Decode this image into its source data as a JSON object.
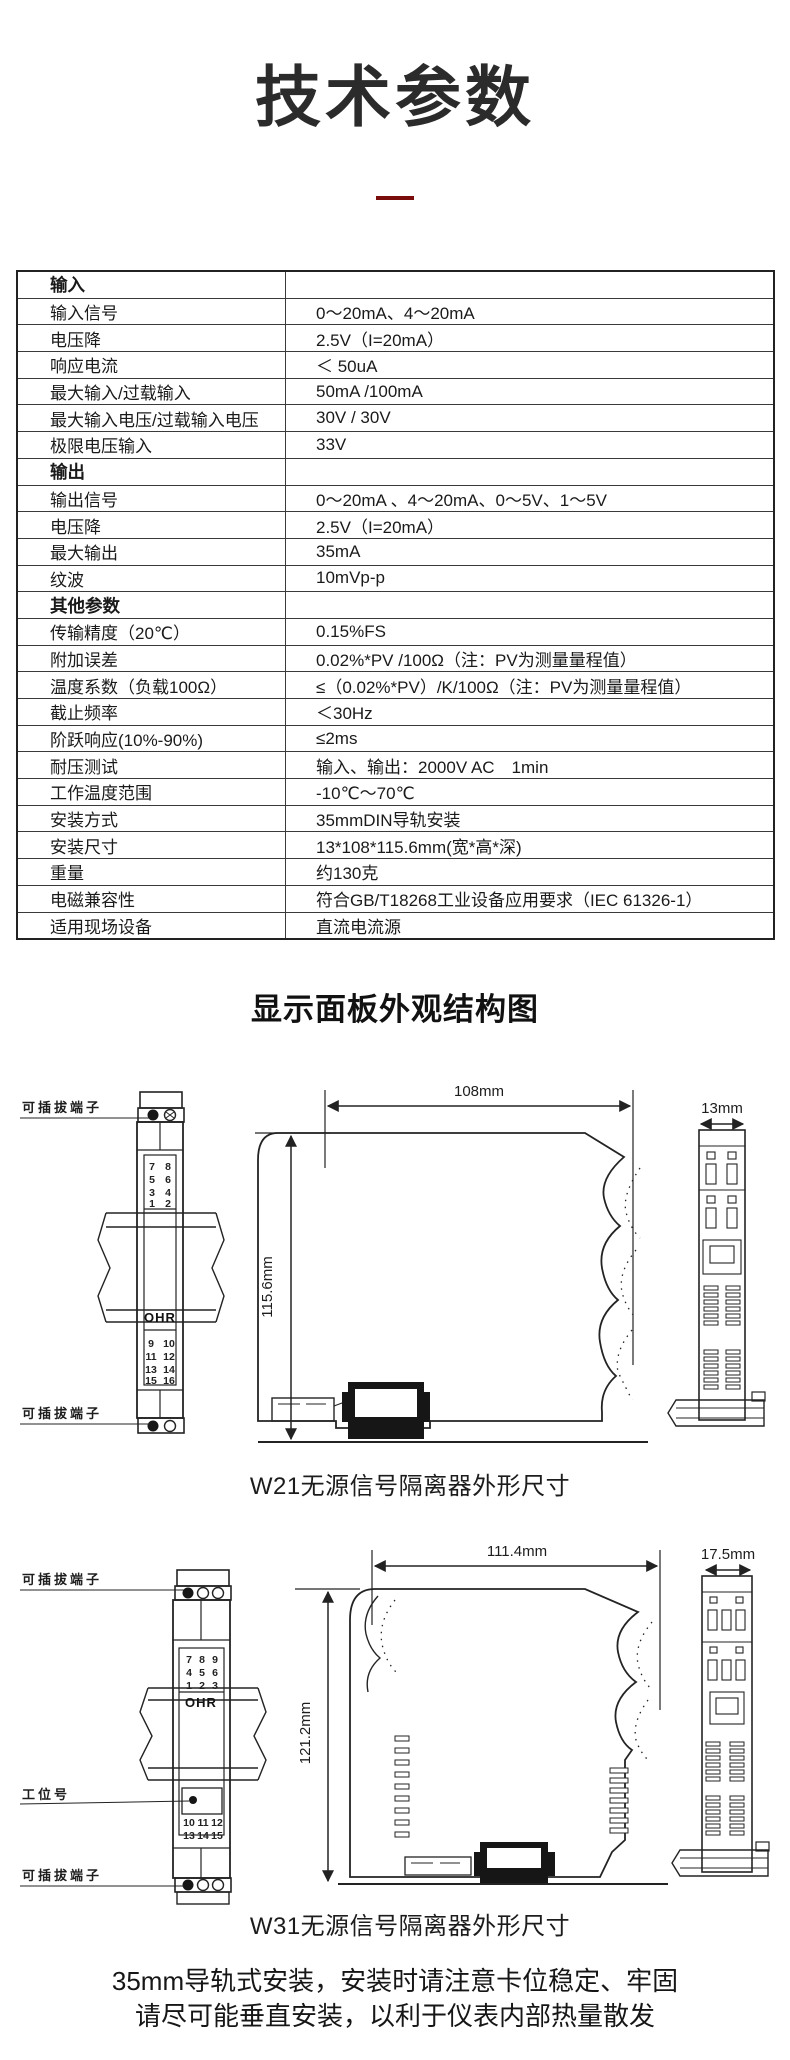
{
  "page": {
    "title": "技术参数",
    "accent_color": "#7a0c0c",
    "section_heading": "显示面板外观结构图",
    "footer_lines": [
      "35mm导轨式安装，安装时请注意卡位稳定、牢固",
      "请尽可能垂直安装，以利于仪表内部热量散发"
    ]
  },
  "spec_table": {
    "rows": [
      {
        "label": "输入",
        "value": "",
        "header": true
      },
      {
        "label": "输入信号",
        "value": "0～20mA、4～20mA",
        "header": false
      },
      {
        "label": "电压降",
        "value": "2.5V（I=20mA）",
        "header": false
      },
      {
        "label": "响应电流",
        "value": "＜ 50uA",
        "header": false
      },
      {
        "label": "最大输入/过载输入",
        "value": "50mA /100mA",
        "header": false
      },
      {
        "label": "最大输入电压/过载输入电压",
        "value": "30V / 30V",
        "header": false
      },
      {
        "label": "极限电压输入",
        "value": "33V",
        "header": false
      },
      {
        "label": "输出",
        "value": "",
        "header": true
      },
      {
        "label": "输出信号",
        "value": "0～20mA 、4～20mA、0～5V、1～5V",
        "header": false
      },
      {
        "label": "电压降",
        "value": "2.5V（I=20mA）",
        "header": false
      },
      {
        "label": "最大输出",
        "value": "35mA",
        "header": false
      },
      {
        "label": "纹波",
        "value": "10mVp-p",
        "header": false
      },
      {
        "label": "其他参数",
        "value": "",
        "header": true
      },
      {
        "label": "传输精度（20℃）",
        "value": "0.15%FS",
        "header": false
      },
      {
        "label": "附加误差",
        "value": "0.02%*PV /100Ω（注：PV为测量量程值）",
        "header": false
      },
      {
        "label": "温度系数（负载100Ω）",
        "value": "≤（0.02%*PV）/K/100Ω（注：PV为测量量程值）",
        "header": false
      },
      {
        "label": "截止频率",
        "value": "＜30Hz",
        "header": false
      },
      {
        "label": "阶跃响应(10%-90%)",
        "value": "≤2ms",
        "header": false
      },
      {
        "label": "耐压测试",
        "value": "输入、输出：2000V AC　1min",
        "header": false
      },
      {
        "label": "工作温度范围",
        "value": "-10℃～70℃",
        "header": false
      },
      {
        "label": "安装方式",
        "value": "35mmDIN导轨安装",
        "header": false
      },
      {
        "label": "安装尺寸",
        "value": "13*108*115.6mm(宽*高*深)",
        "header": false
      },
      {
        "label": "重量",
        "value": "约130克",
        "header": false
      },
      {
        "label": "电磁兼容性",
        "value": "符合GB/T18268工业设备应用要求（IEC 61326-1）",
        "header": false
      },
      {
        "label": "适用现场设备",
        "value": "直流电流源",
        "header": false
      }
    ]
  },
  "diagrams": {
    "w21": {
      "caption": "W21无源信号隔离器外形尺寸",
      "label_terminal_top": "可插拔端子",
      "label_terminal_bottom": "可插拔端子",
      "brand": "OHR",
      "terminals_top": [
        [
          "7",
          "8"
        ],
        [
          "5",
          "6"
        ],
        [
          "3",
          "4"
        ],
        [
          "1",
          "2"
        ]
      ],
      "terminals_bottom": [
        [
          "9",
          "10"
        ],
        [
          "11",
          "12"
        ],
        [
          "13",
          "14"
        ],
        [
          "15",
          "16"
        ]
      ],
      "dim_width": "108mm",
      "dim_height": "115.6mm",
      "dim_depth": "13mm"
    },
    "w31": {
      "caption": "W31无源信号隔离器外形尺寸",
      "label_terminal_top": "可插拔端子",
      "label_station": "工位号",
      "label_terminal_bottom": "可插拔端子",
      "brand": "OHR",
      "terminals_top": [
        [
          "7",
          "8",
          "9"
        ],
        [
          "4",
          "5",
          "6"
        ],
        [
          "1",
          "2",
          "3"
        ]
      ],
      "terminals_bottom": [
        [
          "10",
          "11",
          "12"
        ],
        [
          "13",
          "14",
          "15"
        ]
      ],
      "dim_width": "111.4mm",
      "dim_height": "121.2mm",
      "dim_depth": "17.5mm"
    }
  }
}
